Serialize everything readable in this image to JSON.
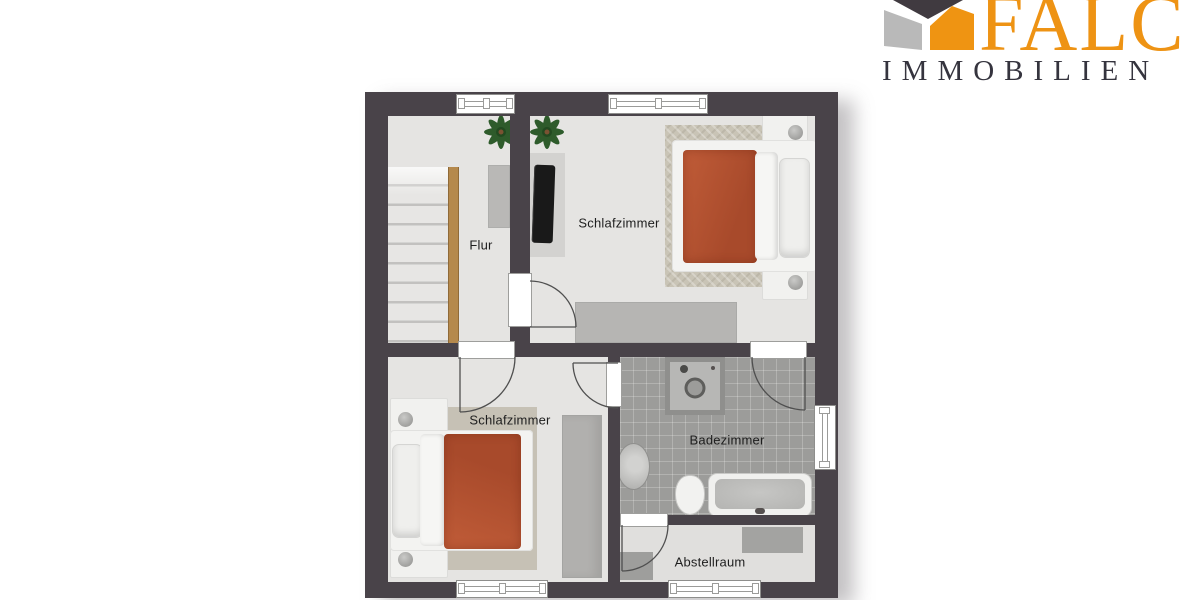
{
  "logo": {
    "brand": "FALC",
    "subtitle": "IMMOBILIEN",
    "brand_color": "#EE9314",
    "subtitle_color": "#35343E"
  },
  "floor_plan": {
    "rooms": [
      {
        "id": "flur",
        "label": "Flur",
        "furniture": [
          "staircase",
          "sideboard",
          "plant"
        ]
      },
      {
        "id": "schlafzimmer-top",
        "label": "Schlafzimmer",
        "furniture": [
          "double-bed",
          "nightstand",
          "nightstand",
          "rug",
          "tv",
          "tv-board",
          "sideboard",
          "plant"
        ]
      },
      {
        "id": "schlafzimmer-bottom",
        "label": "Schlafzimmer",
        "furniture": [
          "double-bed",
          "nightstand",
          "nightstand",
          "rug",
          "wardrobe"
        ]
      },
      {
        "id": "badezimmer",
        "label": "Badezimmer",
        "furniture": [
          "shower",
          "sink",
          "toilet",
          "bathtub"
        ]
      },
      {
        "id": "abstellraum",
        "label": "Abstellraum",
        "furniture": [
          "storage-box",
          "storage-box"
        ]
      }
    ],
    "window_count": 5,
    "door_count": 5,
    "colors": {
      "wall": "#494349",
      "floor": "#e5e4e2",
      "bathroom_tile": "#9c9c9a",
      "duvet_accent": "#b35231",
      "stair_wood": "#b5894c"
    }
  },
  "icons": {
    "falc-house-icon": "angled 3d house mark (dark roof, gray + orange walls)",
    "plant-icon": "top-view leafy plant",
    "shower-head-icon": "dark sprinkler dot",
    "drain-icon": "circular drain ring"
  }
}
